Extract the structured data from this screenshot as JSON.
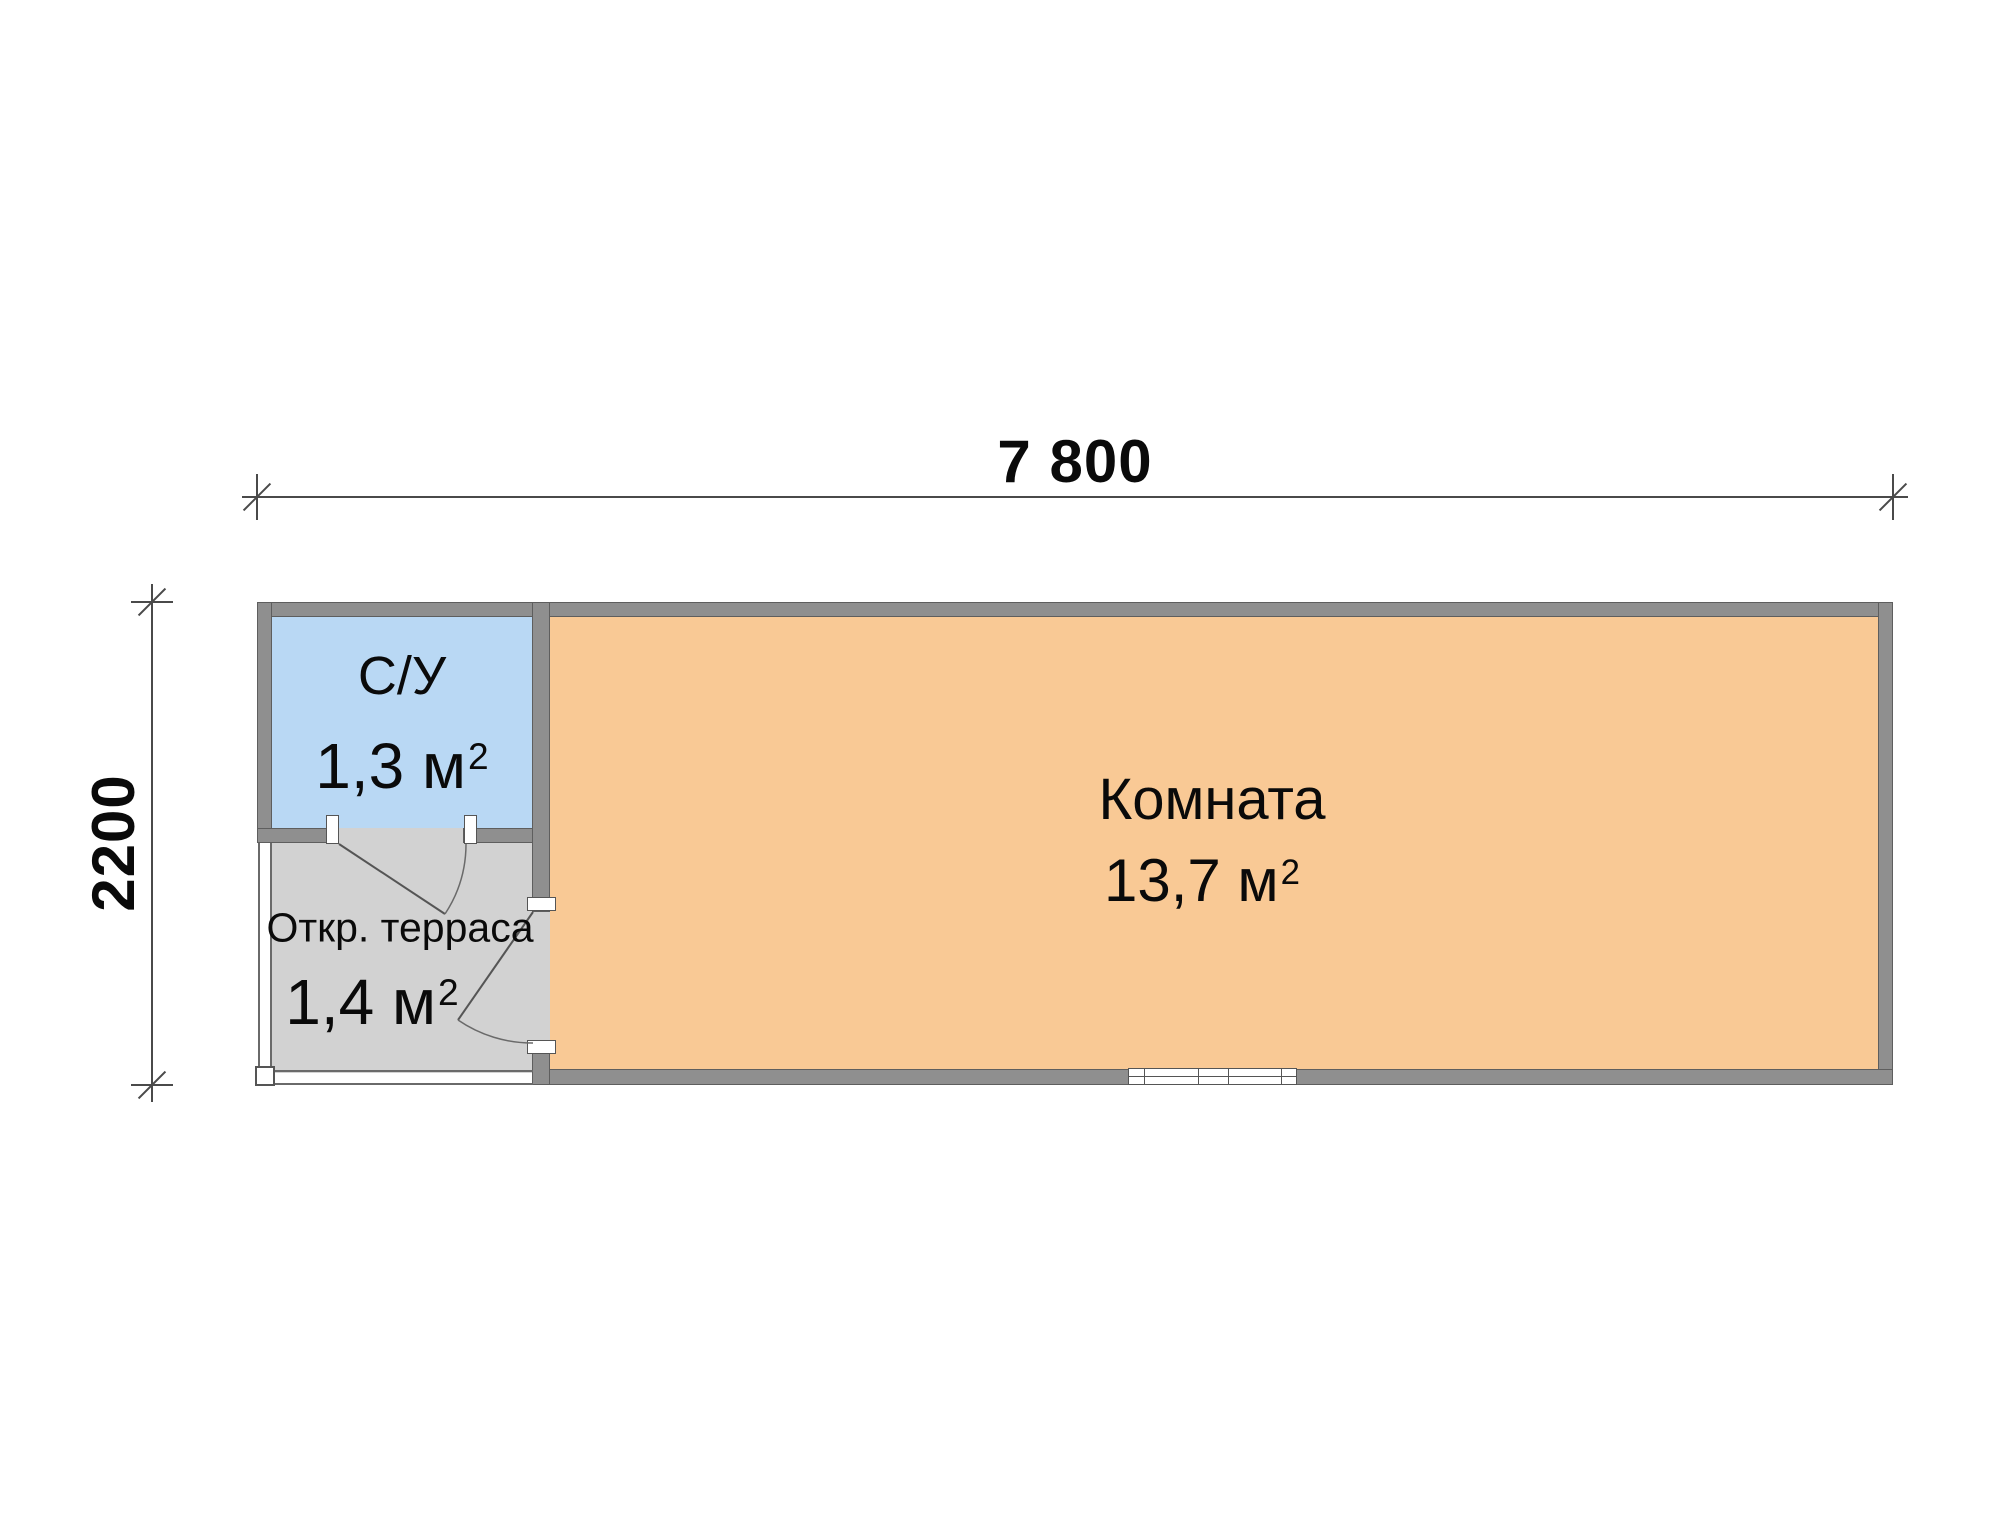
{
  "dimensions": {
    "width_label": "7 800",
    "height_label": "2200"
  },
  "rooms": {
    "bathroom": {
      "label": "С/У",
      "area": "1,3 м",
      "area_superscript": "2"
    },
    "terrace": {
      "label": "Откр. терраса",
      "area": "1,4 м",
      "area_superscript": "2"
    },
    "main": {
      "label": "Комната",
      "area": "13,7 м",
      "area_superscript": "2"
    }
  },
  "colors": {
    "wall": "#8F8F8F",
    "outline": "#5E5E5E",
    "bathroom_fill": "#B9D8F4",
    "terrace_fill": "#D2D2D2",
    "room_fill": "#F9C995"
  }
}
